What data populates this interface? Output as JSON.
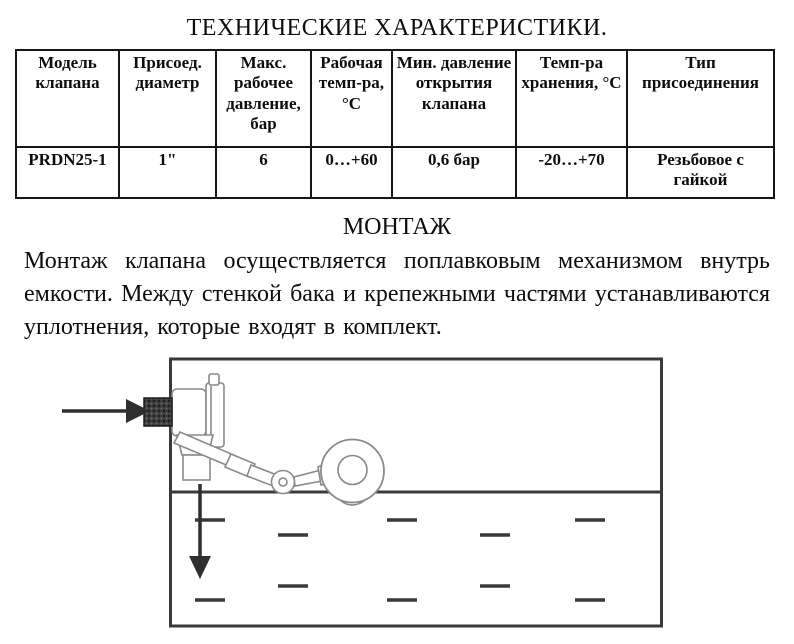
{
  "page": {
    "title": "ТЕХНИЧЕСКИЕ ХАРАКТЕРИСТИКИ.",
    "section_heading": "МОНТАЖ",
    "paragraph": "Монтаж клапана осуществляется поплавковым механизмом внутрь емкости. Между стенкой бака и крепежными частями устанавливаются уплотнения, которые входят в комплект."
  },
  "table": {
    "headers": [
      "Модель клапана",
      "Присоед. диаметр",
      "Макс. рабочее давление, бар",
      "Рабочая темп-ра, °С",
      "Мин. давление открытия клапана",
      "Темп-ра хранения, °С",
      "Тип присоединения"
    ],
    "row": [
      "PRDN25-1",
      "1\"",
      "6",
      "0…+60",
      "0,6 бар",
      "-20…+70",
      "Резьбовое с гайкой"
    ]
  },
  "diagram": {
    "elements": [
      "tank",
      "water-level-line",
      "water-dashes",
      "float-valve",
      "float-ball",
      "inlet-nut",
      "inlet-arrow",
      "outlet-arrow"
    ],
    "colors": {
      "ink": "#3a3a3a",
      "arrow": "#2f2f2f",
      "sketch": "#8a8a8a",
      "nut_dark": "#3c3c3c"
    }
  }
}
